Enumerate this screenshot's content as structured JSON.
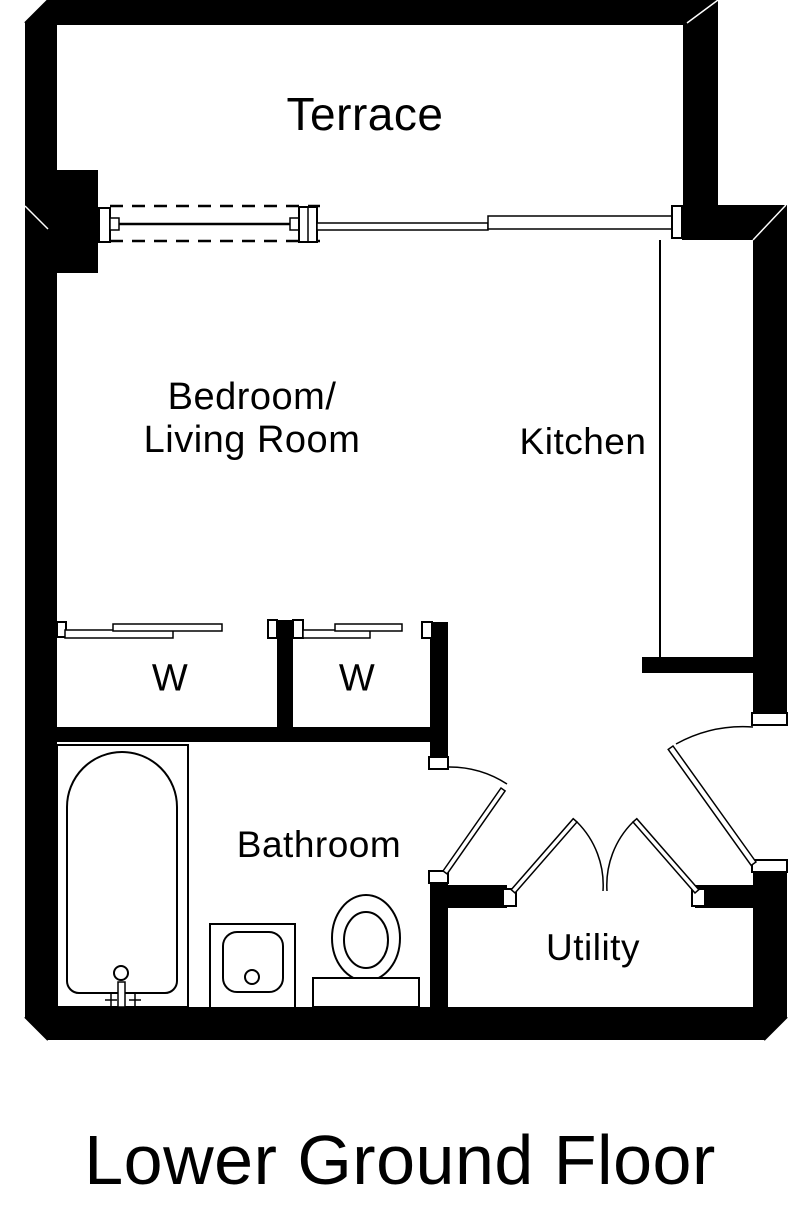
{
  "title": "Lower Ground Floor",
  "colors": {
    "wall": "#000000",
    "line": "#000000",
    "background": "#ffffff"
  },
  "rooms": {
    "terrace": "Terrace",
    "bedroom_living_line1": "Bedroom/",
    "bedroom_living_line2": "Living Room",
    "kitchen": "Kitchen",
    "wardrobe_left": "W",
    "wardrobe_right": "W",
    "bathroom": "Bathroom",
    "utility": "Utility"
  },
  "fixtures": {
    "bathtub": "bathtub",
    "bath_taps": "bath-taps",
    "sink": "sink",
    "toilet": "toilet",
    "kitchen_counter": "kitchen-counter",
    "terrace_sliding_door": "sliding-door",
    "window": "window",
    "wardrobe_sliding_doors": "wardrobe-sliding-doors",
    "bathroom_door": "bathroom-door",
    "entry_door": "entry-door",
    "utility_double_doors": "utility-double-doors"
  }
}
